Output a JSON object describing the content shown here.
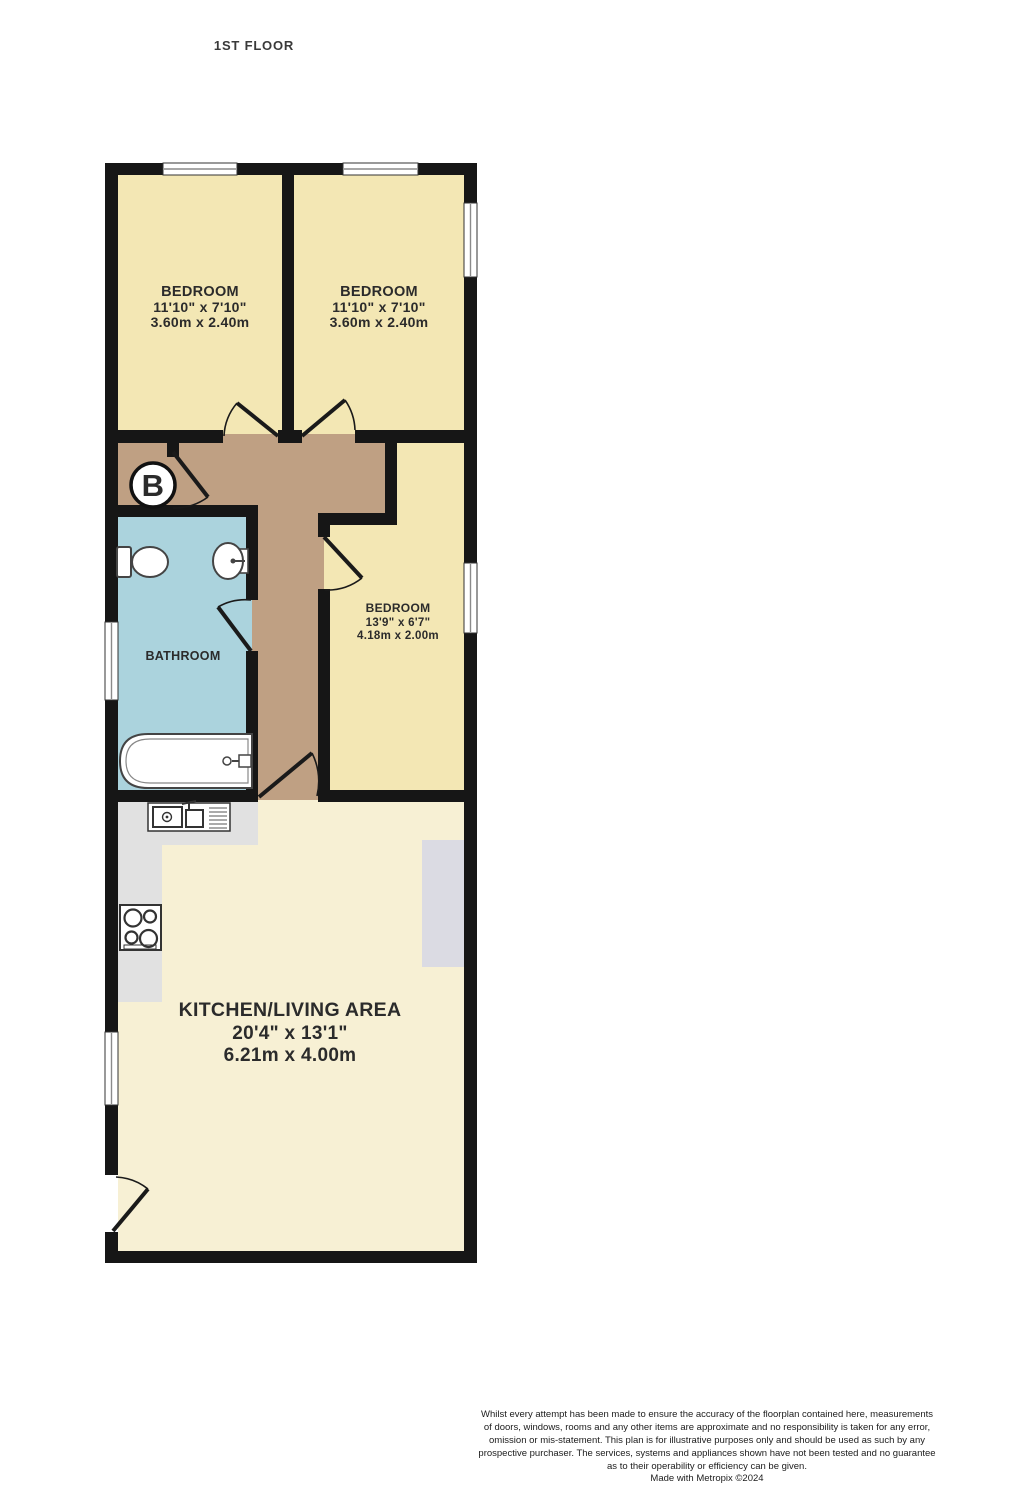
{
  "page": {
    "floor_label": "1ST FLOOR"
  },
  "rooms": {
    "bedroom_1": {
      "name": "BEDROOM",
      "imperial": "11'10\" x 7'10\"",
      "metric": "3.60m x 2.40m"
    },
    "bedroom_2": {
      "name": "BEDROOM",
      "imperial": "11'10\" x 7'10\"",
      "metric": "3.60m x 2.40m"
    },
    "bedroom_3": {
      "name": "BEDROOM",
      "imperial": "13'9\" x 6'7\"",
      "metric": "4.18m x 2.00m"
    },
    "bathroom": {
      "name": "BATHROOM"
    },
    "kitchen_living": {
      "name": "KITCHEN/LIVING AREA",
      "imperial": "20'4\" x 13'1\"",
      "metric": "6.21m x 4.00m"
    }
  },
  "symbols": {
    "boiler": "B"
  },
  "colors": {
    "bedroom_fill": "#f3e7b4",
    "kitchen_fill": "#f7f0d4",
    "hallway_fill": "#bfa083",
    "bathroom_fill": "#abd3dd",
    "counter_fill": "#e1e1e1",
    "furniture_fill": "#dbdbe3",
    "wall": "#161616"
  },
  "footer": {
    "lines": [
      "Whilst every attempt has been made to ensure the accuracy of the floorplan contained here, measurements",
      "of doors, windows, rooms and any other items are approximate and no responsibility is taken for any error,",
      "omission or mis-statement. This plan is for illustrative purposes only and should be used as such by any",
      "prospective purchaser. The services, systems and appliances shown have not been tested and no guarantee",
      "as to their operability or efficiency can be given.",
      "Made with Metropix ©2024"
    ]
  }
}
